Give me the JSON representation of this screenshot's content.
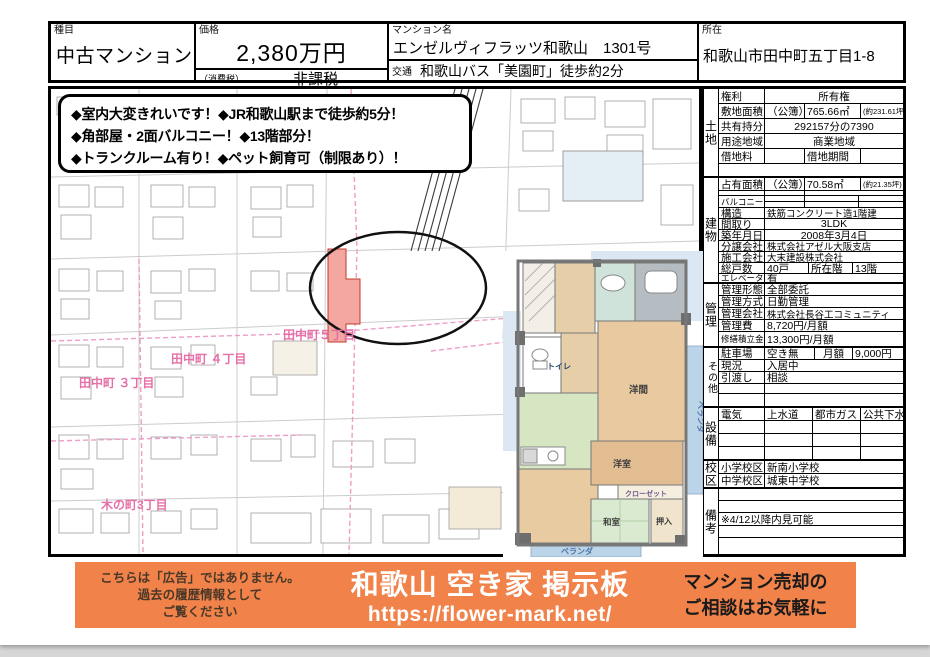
{
  "header": {
    "category_label": "種目",
    "category_value": "中古マンション",
    "price_label": "価格",
    "price_value": "2,380万円",
    "tax_label": "（消費税）",
    "tax_value": "非課税",
    "name_label": "マンション名",
    "name_value": "エンゼルヴィフラッツ和歌山　1301号",
    "access_label": "交通",
    "access_value": "和歌山バス「美園町」徒歩約2分",
    "address_label": "所在",
    "address_value": "和歌山市田中町五丁目1-8"
  },
  "highlights": {
    "line1": "◆室内大変きれいです！◆JR和歌山駅まで徒歩約5分！",
    "line2": "◆角部屋・2面バルコニー！◆13階部分！",
    "line3": "◆トランクルーム有り！◆ペット飼育可（制限あり）！"
  },
  "map": {
    "label_t4": "田中町 ４丁目",
    "label_t3": "田中町 ３丁目",
    "label_t5": "田中町５丁目",
    "label_k3": "木の町3丁目"
  },
  "floorplan": {
    "toilet": "トイレ",
    "youma": "洋間",
    "veranda_right": "ベランダ",
    "youshitsu": "洋室",
    "closet": "クローゼット",
    "washitsu": "和室",
    "oshiire": "押入",
    "veranda_bottom": "ベランダ"
  },
  "land": {
    "title": "土地",
    "kenri_label": "権利",
    "kenri_value": "所有権",
    "area_label": "敷地面積",
    "area_register": "（公簿）",
    "area_value": "765.66㎡",
    "area_tsubo": "(約231.61坪)",
    "share_label": "共有持分",
    "share_value": "292157分の7390",
    "zone_label": "用途地域",
    "zone_value": "商業地域",
    "rent_label": "借地料",
    "rent_term_label": "借地期間"
  },
  "building": {
    "title": "建物",
    "area_label": "占有面積",
    "area_register": "（公簿）",
    "area_value": "70.58㎡",
    "area_tsubo": "(約21.35坪)",
    "balcony_label": "バルコニー",
    "structure_label": "構造",
    "structure_value": "鉄筋コンクリート造1階建",
    "layout_label": "間取り",
    "layout_value": "3LDK",
    "built_label": "築年月日",
    "built_value": "2008年3月4日",
    "developer_label": "分譲会社",
    "developer_value": "株式会社アゼル大阪支店",
    "constructor_label": "施工会社",
    "constructor_value": "大末建設株式会社",
    "units_label": "総戸数",
    "units_value": "40戸",
    "floor_label": "所在階",
    "floor_value": "13階",
    "elevator_label": "エレベーター",
    "elevator_value": "有"
  },
  "management": {
    "title": "管理",
    "form_label": "管理形態",
    "form_value": "全部委託",
    "method_label": "管理方式",
    "method_value": "日勤管理",
    "company_label": "管理会社",
    "company_value": "株式会社長谷工コミュニティ",
    "fee_label": "管理費",
    "fee_value": "8,720円/月額",
    "reserve_label": "修繕積立金",
    "reserve_value": "13,300円/月額"
  },
  "other": {
    "title": "その他",
    "parking_label": "駐車場",
    "parking_value": "空き無",
    "parking_fee_label": "月額",
    "parking_fee_value": "9,000円",
    "status_label": "現況",
    "status_value": "入居中",
    "handover_label": "引渡し",
    "handover_value": "相談"
  },
  "facilities": {
    "title": "設備",
    "c1": "電気",
    "c2": "上水道",
    "c3": "都市ガス",
    "c4": "公共下水"
  },
  "school": {
    "title": "校区",
    "elem_label": "小学校区",
    "elem_value": "新南小学校",
    "junior_label": "中学校区",
    "junior_value": "城東中学校"
  },
  "notes": {
    "title": "備考",
    "note": "※4/12以降内見可能"
  },
  "banner": {
    "disclaimer1": "こちらは「広告」ではありません。",
    "disclaimer2": "過去の履歴情報として",
    "disclaimer3": "ご覧ください",
    "title": "和歌山 空き家 掲示板",
    "url": "https://flower-mark.net/",
    "cta1": "マンション売却の",
    "cta2": "ご相談はお気軽に"
  },
  "colors": {
    "banner_orange": "#f0824a",
    "map_pink": "#e66fa8",
    "highlight_red": "#f4a6a0"
  }
}
